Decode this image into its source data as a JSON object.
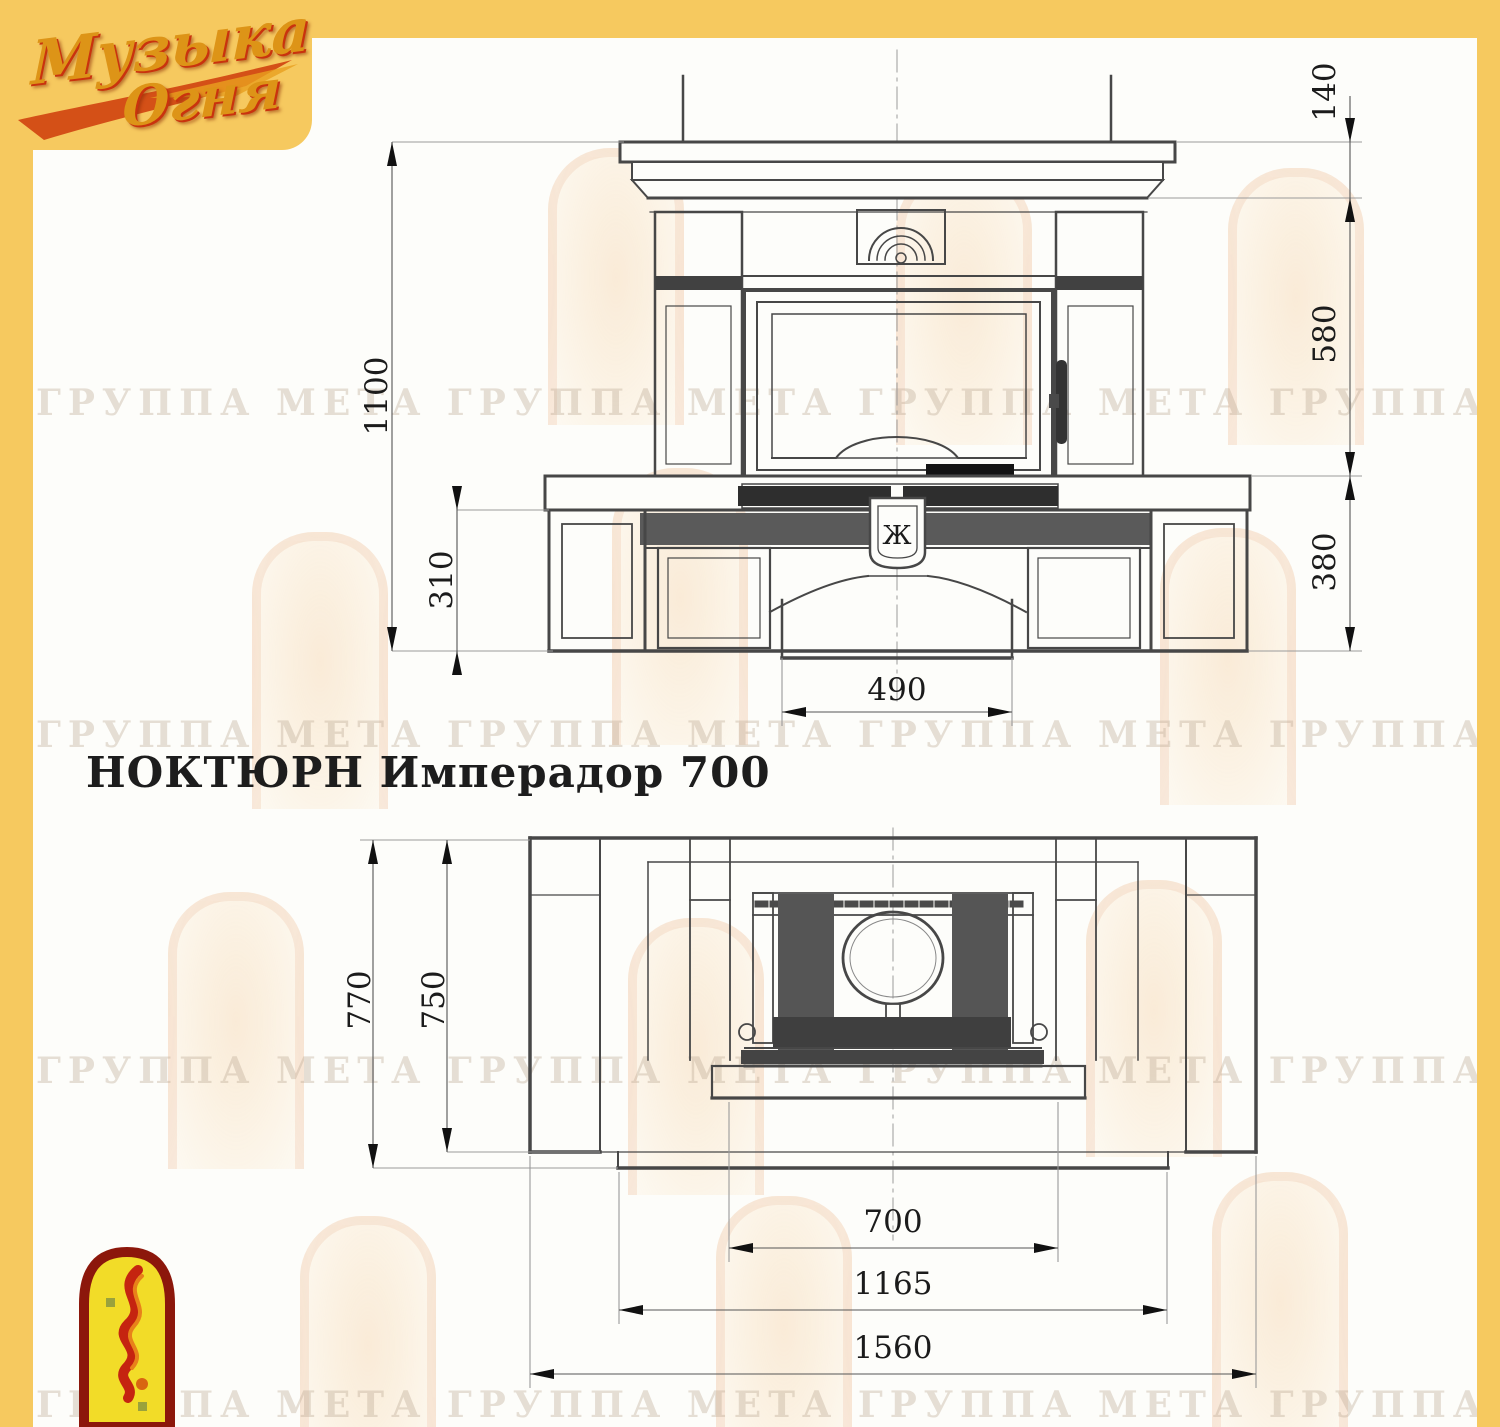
{
  "title": "НОКТЮРН Имперадор 700",
  "logo": {
    "line1": "Музыка",
    "line2": "Огня"
  },
  "watermark_text": "ГРУППА МЕТА    ГРУППА МЕТА    ГРУППА МЕТА    ГРУППА МЕТА",
  "colors": {
    "accent_yellow": "#f6c95f",
    "logo_gold": "#dd9417",
    "logo_red": "#c9330e",
    "drawing_line": "#474747"
  },
  "front_view": {
    "crest_mark": "Ж",
    "dims": {
      "overall_height": "1100",
      "hearth_height": "310",
      "shelf": "140",
      "firebox": "580",
      "base": "380",
      "pedestal_width": "490"
    }
  },
  "plan_view": {
    "dims": {
      "depth_overall": "770",
      "depth_body": "750",
      "insert_width": "700",
      "body_width": "1165",
      "overall_width": "1560"
    }
  }
}
